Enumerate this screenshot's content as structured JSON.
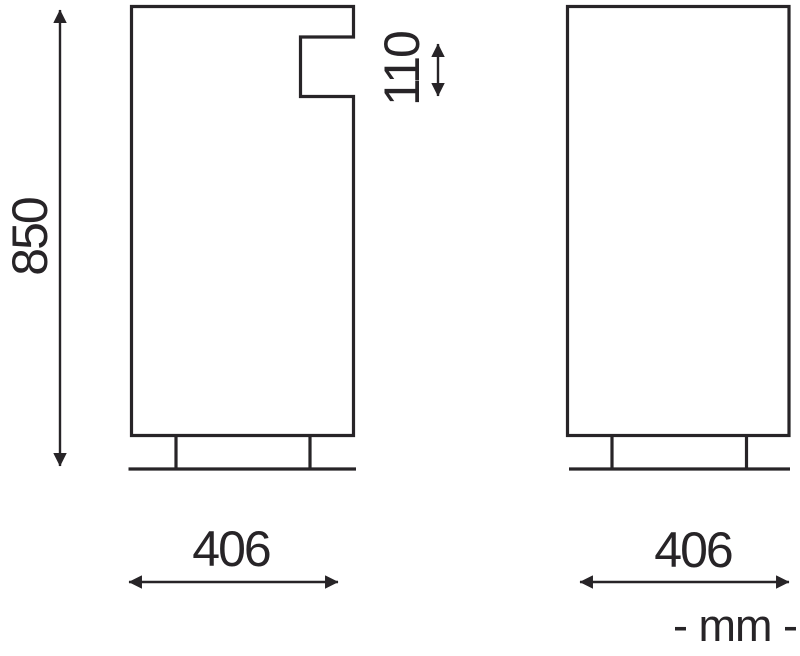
{
  "title": "Product dimension drawing, two views",
  "units_note": "- mm -",
  "views": {
    "front": {
      "name": "front view with recess",
      "height_mm": "850",
      "recess_height_mm": "110",
      "width_mm": "406"
    },
    "side": {
      "name": "side view",
      "width_mm": "406"
    }
  },
  "colors": {
    "line": "#272427",
    "background": "#ffffff"
  }
}
